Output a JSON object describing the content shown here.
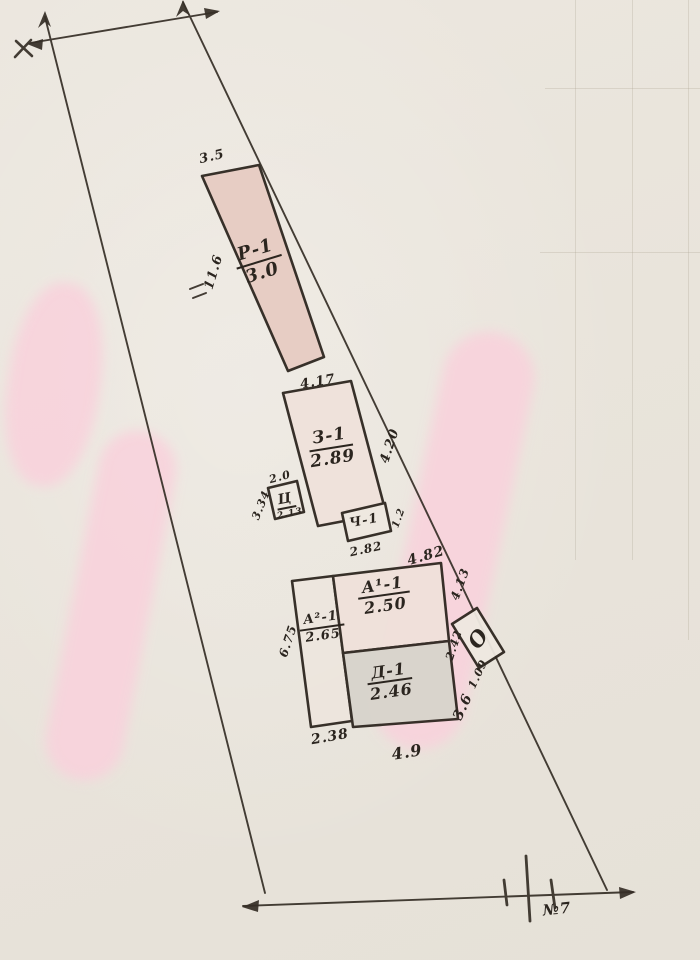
{
  "plot": {
    "number_label": "№7",
    "buildings": [
      {
        "id": "r1",
        "label": "Р-1",
        "value": "3.0"
      },
      {
        "id": "z1",
        "label": "З-1",
        "value": "2.89"
      },
      {
        "id": "ts",
        "label": "Ц"
      },
      {
        "id": "ch1",
        "label": "Ч-1"
      },
      {
        "id": "a1",
        "label": "А¹-1",
        "value": "2.50"
      },
      {
        "id": "a2",
        "label": "А²-1",
        "value": "2.65"
      },
      {
        "id": "d1",
        "label": "Д-1",
        "value": "2.46"
      },
      {
        "id": "o",
        "label": "О"
      }
    ],
    "dimensions": {
      "r1_top": "3.5",
      "r1_side": "11.6",
      "z1_top": "4.17",
      "boundary_z1": "4.20",
      "ts_top": "2.0",
      "ts_side": "3.34",
      "ts_bottom": "2.13",
      "ch1_bottom": "2.82",
      "ch1_side": "1.2",
      "boundary_ch1": "4.82",
      "boundary_a1": "4.13",
      "o_side": "2.42",
      "o_gap": "1.09",
      "boundary_d1": "3.6",
      "a2_side": "6.75",
      "a2_bottom": "2.38",
      "d1_bottom": "4.9"
    }
  }
}
